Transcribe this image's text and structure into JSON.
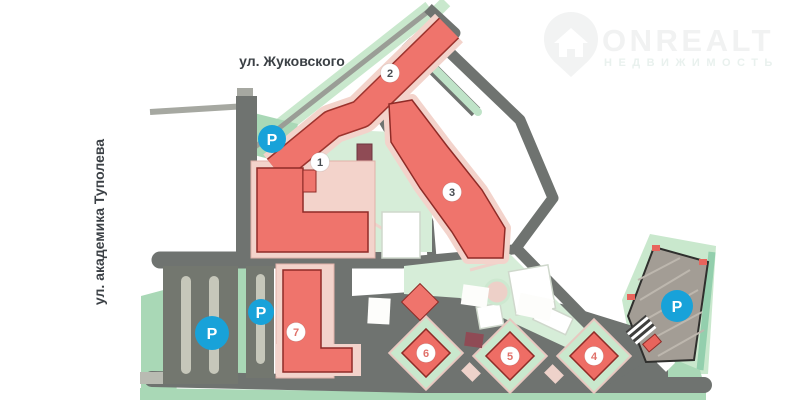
{
  "watermark": {
    "brand": "ONREALT",
    "tagline": "НЕДВИЖИМОСТЬ"
  },
  "streets": {
    "top": "ул. Жуковского",
    "left": "ул. академика Туполева"
  },
  "markers": {
    "buildings": [
      {
        "label": "1",
        "color": "#474c51"
      },
      {
        "label": "2",
        "color": "#474c51"
      },
      {
        "label": "3",
        "color": "#474c51"
      },
      {
        "label": "4",
        "color": "#e0716a"
      },
      {
        "label": "5",
        "color": "#e0716a"
      },
      {
        "label": "6",
        "color": "#e0716a"
      },
      {
        "label": "7",
        "color": "#e0716a"
      }
    ],
    "parking": [
      {
        "label": "P"
      },
      {
        "label": "P"
      },
      {
        "label": "P"
      },
      {
        "label": "P"
      }
    ]
  },
  "colors": {
    "building_red": "#ef746c",
    "building_outline": "#8f2b27",
    "podium_pink": "#f3d3cb",
    "road_dark": "#6f7370",
    "road_light": "#a6a8a1",
    "green_light": "#c9e8cd",
    "green_mid": "#a9d8b6",
    "courtyard_mint": "#d6edd8",
    "parking_blue": "#18a2d9",
    "label_dark": "#3b4045"
  }
}
